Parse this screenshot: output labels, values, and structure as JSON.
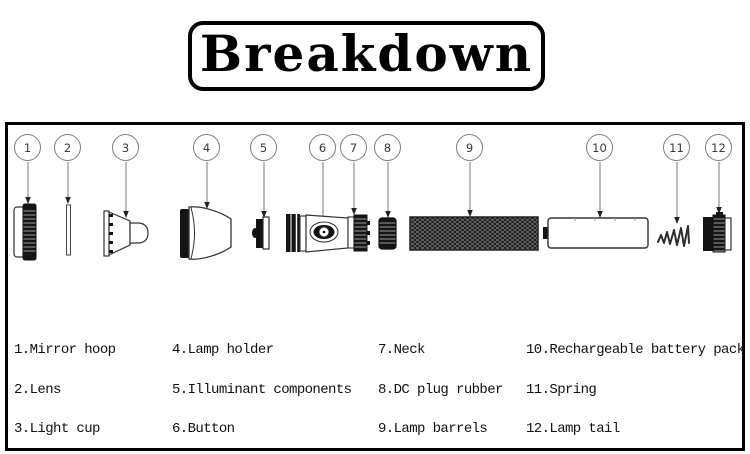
{
  "title": {
    "text": "Breakdown"
  },
  "diagram": {
    "callouts": [
      {
        "num": "1",
        "part": "Mirror hoop"
      },
      {
        "num": "2",
        "part": "Lens"
      },
      {
        "num": "3",
        "part": "Light cup"
      },
      {
        "num": "4",
        "part": "Lamp holder"
      },
      {
        "num": "5",
        "part": "Illuminant components"
      },
      {
        "num": "6",
        "part": "Button"
      },
      {
        "num": "7",
        "part": "Neck"
      },
      {
        "num": "8",
        "part": "DC plug rubber"
      },
      {
        "num": "9",
        "part": "Lamp barrels"
      },
      {
        "num": "10",
        "part": "Rechargeable battery pack"
      },
      {
        "num": "11",
        "part": "Spring"
      },
      {
        "num": "12",
        "part": "Lamp tail"
      }
    ]
  },
  "legend": {
    "items": [
      {
        "num": "1.",
        "name": "Mirror hoop"
      },
      {
        "num": "2.",
        "name": "Lens"
      },
      {
        "num": "3.",
        "name": "Light cup"
      },
      {
        "num": "4.",
        "name": "Lamp holder"
      },
      {
        "num": "5.",
        "name": "Illuminant components"
      },
      {
        "num": "6.",
        "name": "Button"
      },
      {
        "num": "7.",
        "name": "Neck"
      },
      {
        "num": "8.",
        "name": "DC plug rubber"
      },
      {
        "num": "9.",
        "name": "Lamp barrels"
      },
      {
        "num": "10.",
        "name": "Rechargeable battery pack"
      },
      {
        "num": "11.",
        "name": "Spring"
      },
      {
        "num": "12.",
        "name": "Lamp tail"
      }
    ]
  }
}
